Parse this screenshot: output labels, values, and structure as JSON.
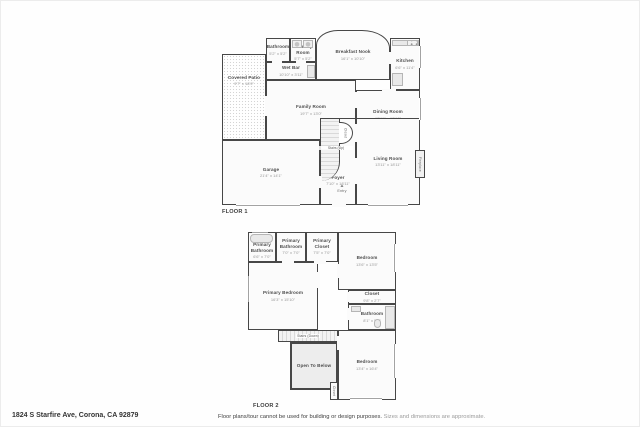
{
  "colors": {
    "wall": "#474747",
    "room_fill": "#fbfbfb",
    "patio_dot": "#d4d4d4",
    "fixture_fill": "#e9e9e9",
    "open_fill": "#ededed",
    "label": "#4e4e4e",
    "dims": "#989898"
  },
  "icons": {
    "entry_triangle": "▲"
  },
  "floor1": {
    "label": "FLOOR 1",
    "rooms": {
      "covered_patio": {
        "name": "Covered Patio",
        "dims": "9'7\" x 18'9\""
      },
      "bathroom": {
        "name": "Bathroom",
        "dims": "5'2\" x 5'2\""
      },
      "laundry": {
        "name": "Laundry Room",
        "dims": "5'7\" x 5'2\""
      },
      "breakfast_nook": {
        "name": "Breakfast Nook",
        "dims": "16'1\" x 10'10\""
      },
      "kitchen": {
        "name": "Kitchen",
        "dims": "6'6\" x 11'4\""
      },
      "wet_bar": {
        "name": "Wet Bar",
        "dims": "10'10\" x 3'11\""
      },
      "family_room": {
        "name": "Family Room",
        "dims": "19'7\" x 13'0\""
      },
      "dining_room": {
        "name": "Dining Room",
        "dims": "13'11\" x 10'10\""
      },
      "garage": {
        "name": "Garage",
        "dims": "21'4\" x 14'1\""
      },
      "foyer": {
        "name": "Foyer",
        "dims": "7'10\" x 18'11\""
      },
      "living_room": {
        "name": "Living Room",
        "dims": "13'11\" x 18'11\""
      },
      "stairs_up": {
        "name": "Stairs (Up)"
      },
      "closet": {
        "name": "Closet"
      },
      "fireplace": {
        "name": "Fireplace"
      },
      "entry": {
        "name": "Entry"
      }
    }
  },
  "floor2": {
    "label": "FLOOR 2",
    "rooms": {
      "primary_bathroom_1": {
        "name": "Primary Bathroom",
        "dims": "6'6\" x 7'0\""
      },
      "primary_bathroom_2": {
        "name": "Primary Bathroom",
        "dims": "7'0\" x 7'0\""
      },
      "primary_closet": {
        "name": "Primary Closet",
        "dims": "7'5\" x 7'0\""
      },
      "bedroom_top": {
        "name": "Bedroom",
        "dims": "13'6\" x 13'5\""
      },
      "primary_bedroom": {
        "name": "Primary Bedroom",
        "dims": "16'3\" x 15'10\""
      },
      "closet_mid": {
        "name": "Closet",
        "dims": "9'8\" x 2'7\""
      },
      "bathroom_small": {
        "name": "Bathroom",
        "dims": "8'1\" x 5'8\""
      },
      "stairs_down": {
        "name": "Stairs (Down)"
      },
      "open_to_below": {
        "name": "Open To Below"
      },
      "bedroom_bottom": {
        "name": "Bedroom",
        "dims": "13'4\" x 16'4\""
      },
      "closet_small": {
        "name": "Closet"
      }
    }
  },
  "footer": {
    "address": "1824 S Starfire Ave, Corona, CA 92879",
    "disclaimer_main": "Floor plans/tour cannot be used for building or design purposes.",
    "disclaimer_note": "Sizes and dimensions are approximate."
  }
}
